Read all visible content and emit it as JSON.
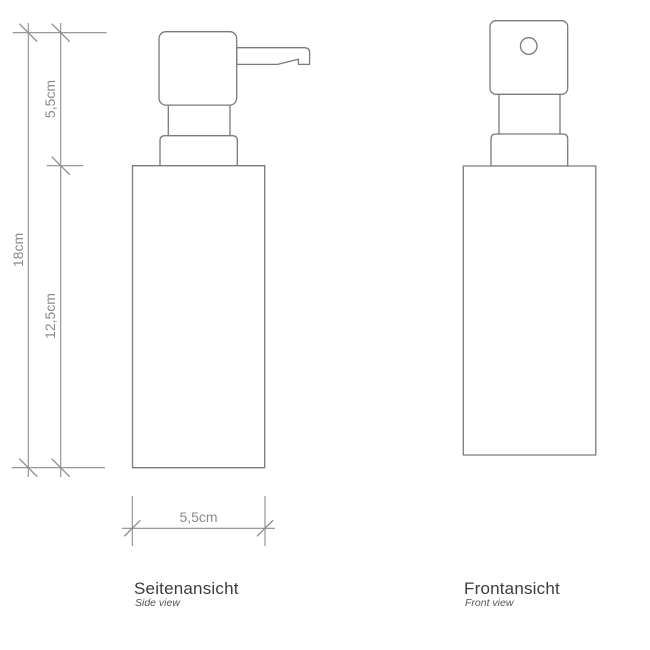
{
  "drawing": {
    "type": "technical-drawing",
    "subject": "soap dispenser with pump head",
    "views": [
      {
        "id": "side",
        "title": "Seitenansicht",
        "subtitle": "Side view"
      },
      {
        "id": "front",
        "title": "Frontansicht",
        "subtitle": "Front view"
      }
    ],
    "dimensions": {
      "pump_height": "5,5cm",
      "total_height": "18cm",
      "body_height": "12,5cm",
      "body_width": "5,5cm"
    },
    "dimensions_cm": {
      "pump_height": 5.5,
      "total_height": 18,
      "body_height": 12.5,
      "body_width": 5.5
    },
    "colors": {
      "background": "#ffffff",
      "object_line": "#7a7a7a",
      "dimension_line": "#8c8c8c",
      "dimension_text": "#8a8a8a",
      "title_text": "#3c3c3c",
      "subtitle_text": "#555555"
    }
  }
}
